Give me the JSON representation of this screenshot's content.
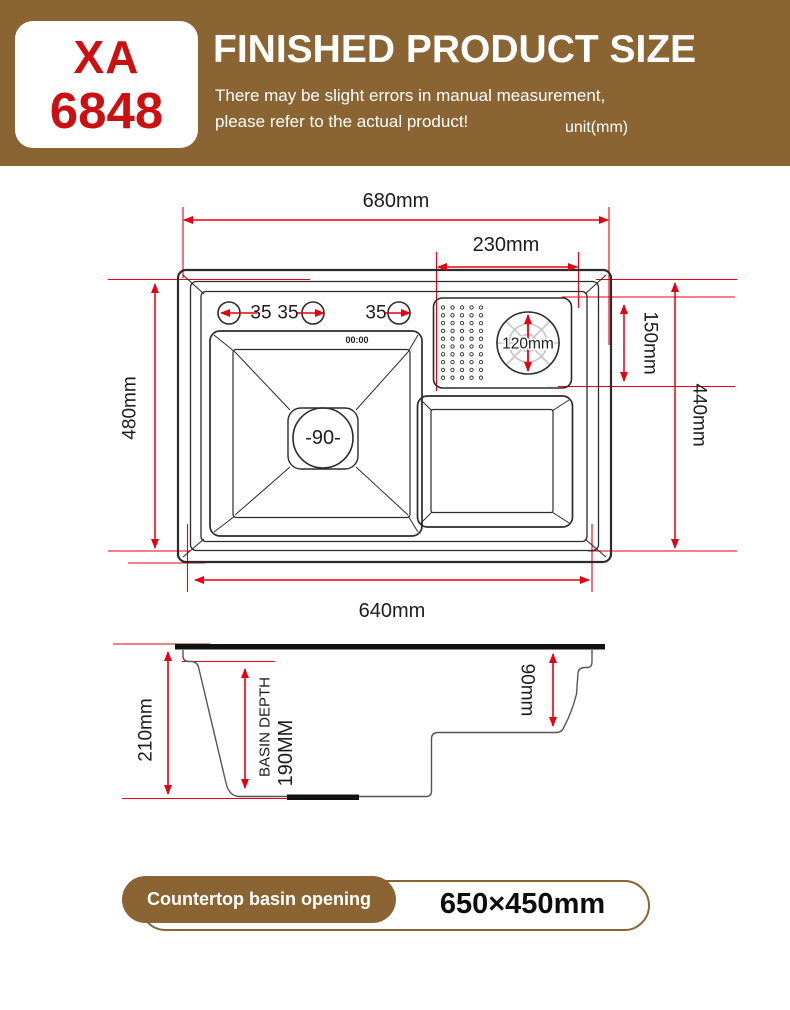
{
  "header": {
    "model_line1": "XA",
    "model_line2": "6848",
    "title": "FINISHED PRODUCT SIZE",
    "subtitle_line1": "There may be slight errors in manual measurement,",
    "subtitle_line2": "please refer to the actual product!",
    "unit": "unit(mm)"
  },
  "top_view": {
    "dim_width_outer": "680mm",
    "dim_drainboard_width": "230mm",
    "dim_height_outer": "480mm",
    "dim_height_inner": "440mm",
    "dim_drainboard_height": "150mm",
    "dim_width_inner": "640mm",
    "faucet_labels": [
      "35",
      "35",
      "35"
    ],
    "clock_display": "00:00",
    "drain_label": "-90-",
    "flange_label": "120mm"
  },
  "side_view": {
    "dim_total_depth": "210mm",
    "basin_depth_line1": "BASIN DEPTH",
    "basin_depth_line2": "190MM",
    "dim_small_basin_depth": "90mm"
  },
  "footer": {
    "label": "Countertop basin opening",
    "value": "650×450mm"
  },
  "colors": {
    "header_brown": "#8a6432",
    "model_red": "#cc1012",
    "dimension_red": "#e60012",
    "line_black": "#2b2b2b",
    "flange_gray": "#c5c5c5"
  }
}
